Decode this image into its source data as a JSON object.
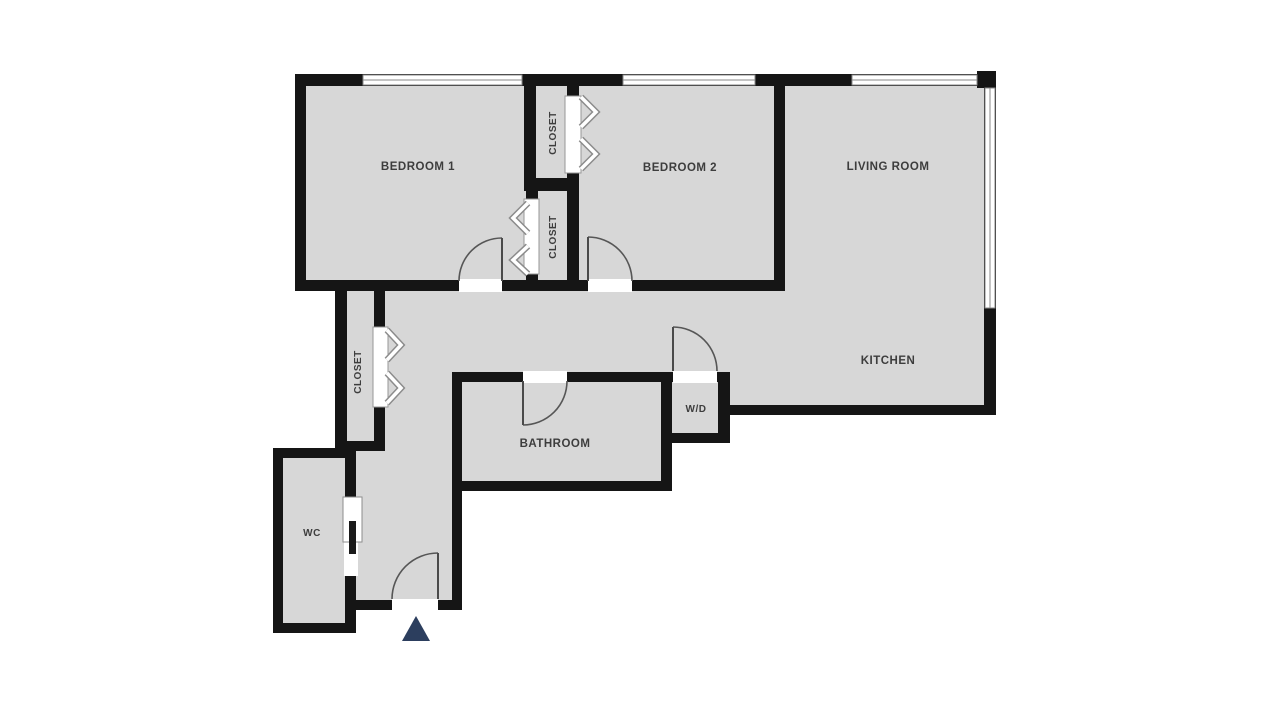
{
  "colors": {
    "floor": "#d7d7d7",
    "wall": "#151515",
    "label": "#3d3d3d",
    "arc": "#565656",
    "entry_arrow": "#2c3e5e"
  },
  "rooms": {
    "bedroom1": {
      "label": "BEDROOM 1"
    },
    "bedroom2": {
      "label": "BEDROOM 2"
    },
    "living_room": {
      "label": "LIVING ROOM"
    },
    "kitchen": {
      "label": "KITCHEN"
    },
    "bathroom": {
      "label": "BATHROOM"
    },
    "wd_closet": {
      "label": "W/D"
    },
    "wc": {
      "label": "WC"
    },
    "closet_top": {
      "label": "CLOSET"
    },
    "closet_middle": {
      "label": "CLOSET"
    },
    "closet_hall": {
      "label": "CLOSET"
    }
  },
  "icons": {
    "entry_arrow": "entrance-arrow",
    "windows": "window-symbol",
    "door_arcs": "door-swing-symbol",
    "chevrons": "bifold-door-symbol"
  }
}
